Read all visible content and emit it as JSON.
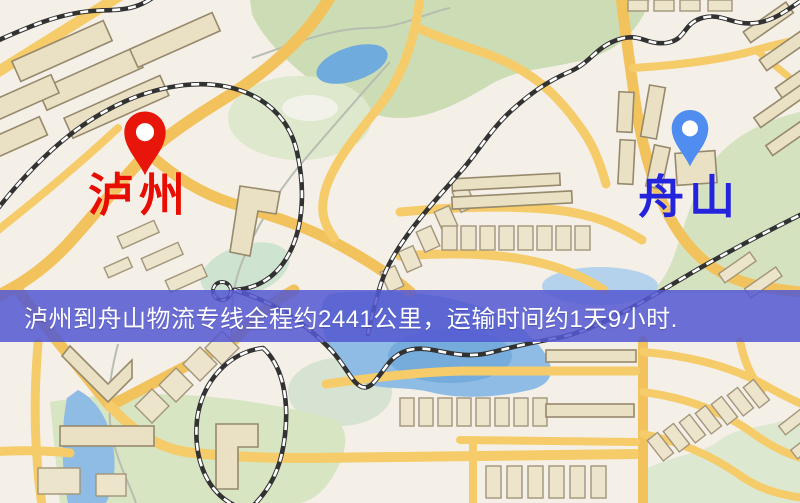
{
  "map": {
    "origin": {
      "name": "泸州",
      "pin_color": "#e8150b",
      "label_color": "#e80d00"
    },
    "destination": {
      "name": "舟山",
      "pin_color": "#4f8df1",
      "label_color": "#2424dc"
    },
    "banner": {
      "text": "泸州到舟山物流专线全程约2441公里，运输时间约1天9小时.",
      "background_color": "#5458d2",
      "text_color": "#ffffff"
    },
    "route_info": {
      "distance_text": "约2441公里",
      "duration_text": "约1天9小时"
    },
    "palette": {
      "background": "#f4efe7",
      "road": "#f5cc69",
      "park": "#ccdcb4",
      "water": "#8cbade",
      "building": "#eae1c4",
      "railway": "#323232"
    }
  }
}
